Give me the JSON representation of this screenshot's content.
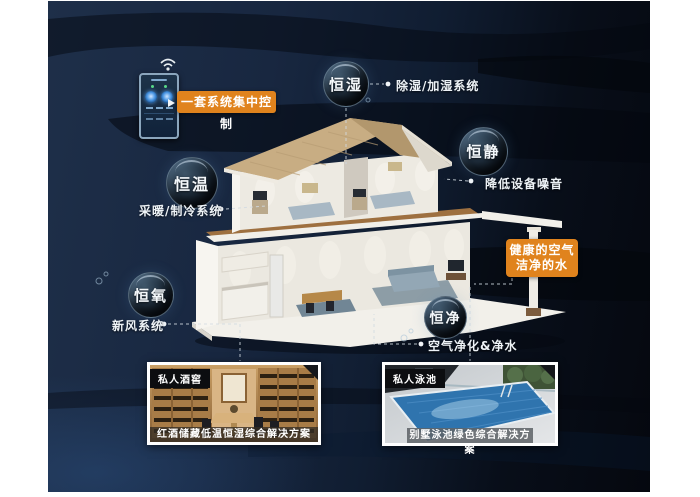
{
  "colors": {
    "accent_orange": "#e0831d",
    "panel_navy": "#16243a",
    "panel_dark_right": "#05080f",
    "bubble_rim": "#a5c3dc",
    "connector_line": "#d2dbe2",
    "pool_blue": "#2f74ae",
    "cellar_wood": "#b98f5e"
  },
  "control_panel": {
    "callout": "一套系统集中控制",
    "wifi_icon": "wifi-icon",
    "device": "wall-mounted smart controller with two glowing dials"
  },
  "features": [
    {
      "name": "恒湿",
      "note": "除湿/加湿系统"
    },
    {
      "name": "恒静",
      "note": "降低设备噪音"
    },
    {
      "name": "恒温",
      "note": "采暖/制冷系统"
    },
    {
      "name": "恒氧",
      "note": "新风系统"
    },
    {
      "name": "恒净",
      "note": "空气净化&净水"
    }
  ],
  "callouts": {
    "control": "一套系统集中控制",
    "health_line1": "健康的空气",
    "health_line2": "洁净的水"
  },
  "photos": [
    {
      "tag": "私人酒窖",
      "caption": "红酒储藏低温恒湿综合解决方案"
    },
    {
      "tag": "私人泳池",
      "caption": "别墅泳池绿色综合解决方案"
    }
  ]
}
